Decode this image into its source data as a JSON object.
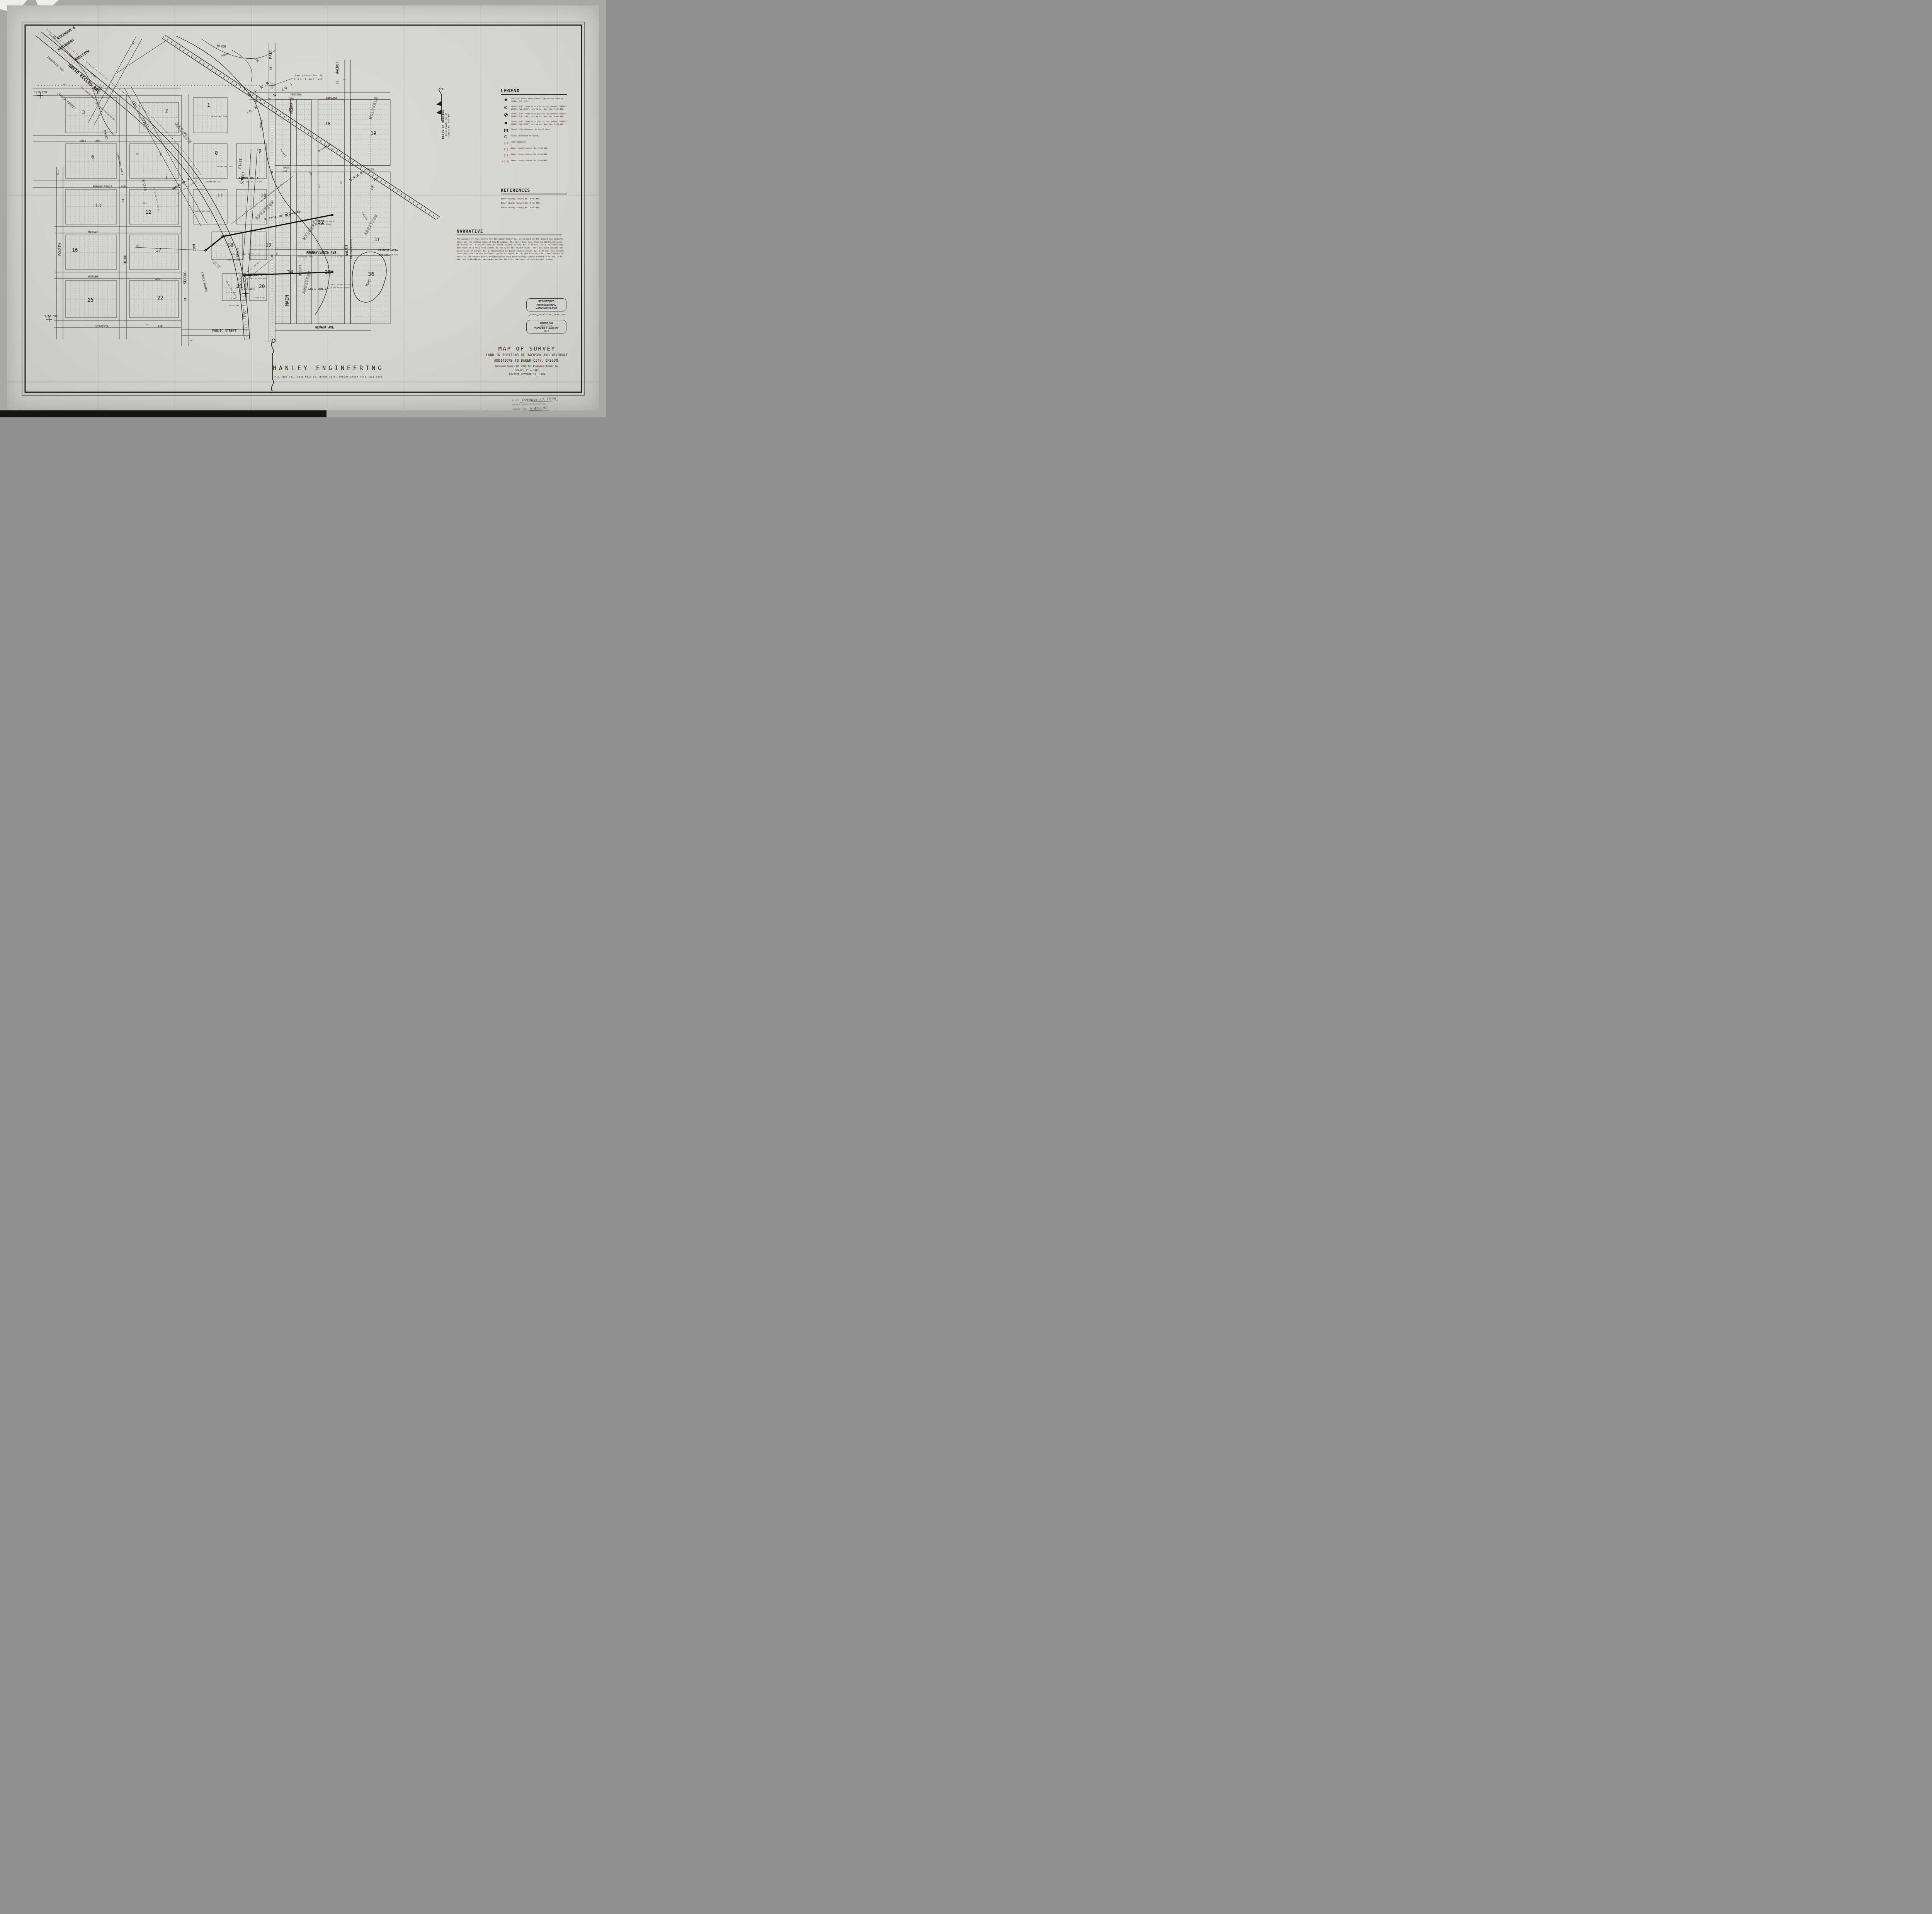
{
  "colors": {
    "paper": "#d8d6d1",
    "ink": "#1b1b1b",
    "stamp_ink": "#5e5e5e"
  },
  "legend": {
    "title": "LEGEND",
    "items": [
      {
        "sym": "dot",
        "sym_text": "",
        "text": "Set 5/8\" rebar with plastic cap marked \"HANLEY ENGRG. PLS 1817\"."
      },
      {
        "sym": "circledot",
        "sym_text": "",
        "text": "Found, 5/8\" rebar with plastic cap marked \"HANLEY ENGRG. PLS 1206\", set by Co. Sur. No. 9-40-466."
      },
      {
        "sym": "quarter",
        "sym_text": "",
        "text": "Found, 5/8\" rebar with plastic cap marked \"HANLEY ENGRG. PLS 1206\", set by Co. Sur. No. 9-40-486."
      },
      {
        "sym": "square",
        "sym_text": "",
        "text": "Found, 5/8\" rebar with plastic cap marked \"HANLEY ENGRG. PLS 1206\", set by Co. Sur. No. 9-40-490."
      },
      {
        "sym": "opensquare",
        "sym_text": "",
        "text": "Found, city monument in steel case."
      },
      {
        "sym": "opencircle",
        "sym_text": "",
        "text": "Found, monument as noted."
      },
      {
        "sym": "text",
        "sym_text": "(  )",
        "text": "Plat distance."
      },
      {
        "sym": "text",
        "sym_text": "{  }",
        "text": "Baker County Survey No. 9-40-466."
      },
      {
        "sym": "text",
        "sym_text": "[  ]",
        "text": "Baker County Survey No. 9-40-486."
      },
      {
        "sym": "text",
        "sym_text": "((  ))",
        "text": "Baker County Survey No. 9-40-490."
      }
    ]
  },
  "references": {
    "title": "REFERENCES",
    "items": [
      "Baker County Survey No. 9-40-466.",
      "Baker County Survey No. 9-40-486.",
      "Baker County Survey No. 9-40-490."
    ]
  },
  "narrative": {
    "title": "NARRATIVE",
    "text": "The purpose of this survey for Ellingson Timber Co. is to mark on the ground two property lines per the instructions of Rob Ellingson.  The first line runs from the Northeast corner of Parcel No. B established by Baker County Survey No. 9-40-486, in a Northeasterly direction to a 40.9 feet offset to the \u2104 of the Powder River.  This new line adjusts the South line of Parcel No. C established by Baker County Survey No. 9-40-490.  The second line runs from the the Southeast corner of Parcel No. B, due East to a 68.1 feet offset to the \u2104 of the Powder River.  Monumentation from Baker County Survey Numbers 9-40-466, 9-40-486, and 9-40-490 was recovered and was held for the basis of this subject survey."
  },
  "basis_of_bearing": {
    "title": "BASIS OF BEARING",
    "line1": "Baker County Map of",
    "line2": "Survey No. 9-40-490."
  },
  "title_block": {
    "title": "MAP OF SURVEY",
    "subtitle1": "LAND IN PORTIONS OF JACKSON AND WILOVALE",
    "subtitle2": "ADDITIONS TO BAKER CITY, OREGON.",
    "surveyed": "Surveyed August 19, 1999 for Ellingson Timber Co.",
    "scale": "Scale: 1\" = 100'",
    "revised": "REVISED OCTOBER 15, 1999"
  },
  "surveyor_stamp": {
    "line1": "REGISTERED",
    "line2": "PROFESSIONAL",
    "line3": "LAND SURVEYOR",
    "state": "OREGON",
    "date": "JULY, 13, 1979",
    "name": "THOMAS J. HANLEY",
    "number": "1817"
  },
  "filing_stamp": {
    "filed_label": "FILED",
    "filed_value": "October 13, 1999",
    "office": "BAKER COUNTY SURVEYOR",
    "survey_no_label": "SURVEY NO.",
    "survey_no_value": "9-40-502"
  },
  "firm_block": {
    "name": "HANLEY ENGINEERING",
    "address": "P.O. Box 701, 2043 Main St. BAKER CITY, OREGON 97814      (541) 523-3803"
  },
  "map_labels": [
    [
      "ATKINSON &",
      150,
      103,
      -34,
      9,
      "b"
    ],
    [
      "HENINGERS",
      152,
      132,
      -34,
      9,
      "b"
    ],
    [
      "ADDITION",
      196,
      158,
      -34,
      9,
      "b"
    ],
    [
      "INDUSTRIAL AVE.",
      121,
      148,
      42,
      6.5,
      "n"
    ],
    [
      "DAVID ECCLES RD.",
      176,
      170,
      42,
      11,
      "b"
    ],
    [
      "(TRUCK ROUTE)",
      147,
      242,
      42,
      8,
      "n"
    ],
    [
      "(OLD SUMPTER VALLEY R.R.)",
      208,
      225,
      42,
      4.5,
      "n"
    ],
    [
      "ORD. 2993, DEED 91-09-061",
      246,
      267,
      42,
      4.5,
      "n"
    ],
    [
      "OLD",
      137,
      96,
      42,
      5,
      "n"
    ],
    [
      "SETTLERS",
      176,
      142,
      42,
      5,
      "n"
    ],
    [
      "SLOUGH",
      234,
      190,
      42,
      5,
      "n"
    ],
    [
      "1/16 COR.",
      88,
      241,
      0,
      7,
      "n"
    ],
    [
      "AVE.",
      240,
      234,
      0,
      7,
      "n"
    ],
    [
      "60'",
      163,
      220,
      0,
      4.5,
      "n"
    ],
    [
      "ROSE",
      256,
      245,
      -70,
      9,
      "n"
    ],
    [
      "ST.",
      346,
      116,
      -70,
      7,
      "n"
    ],
    [
      "CARY",
      341,
      264,
      58,
      8,
      "n"
    ],
    [
      "STREET",
      366,
      308,
      58,
      8,
      "n"
    ],
    [
      "JACKSON",
      452,
      320,
      55,
      13,
      "o"
    ],
    [
      "ST.",
      152,
      452,
      -90,
      7,
      "n"
    ],
    [
      "FOURTH",
      158,
      662,
      -90,
      9,
      "n"
    ],
    [
      "ST.",
      321,
      523,
      -90,
      7,
      "n"
    ],
    [
      "THIRD",
      327,
      686,
      -90,
      9,
      "n"
    ],
    [
      "SECOND",
      482,
      735,
      -90,
      9,
      "n"
    ],
    [
      "ST.",
      482,
      779,
      -90,
      7,
      "n"
    ],
    [
      "OHIO",
      206,
      367,
      0,
      7,
      "n"
    ],
    [
      "AVE.",
      247,
      367,
      0,
      7,
      "n"
    ],
    [
      "PENNSYLVANIA",
      240,
      485,
      0,
      7,
      "n"
    ],
    [
      "AVE.",
      313,
      485,
      0,
      7,
      "n"
    ],
    [
      "NEVADA",
      228,
      602,
      0,
      7,
      "n"
    ],
    [
      "WABASH",
      228,
      718,
      0,
      7,
      "n"
    ],
    [
      "AVE.",
      402,
      724,
      0,
      7,
      "n"
    ],
    [
      "VIRGINIA",
      247,
      847,
      0,
      7,
      "n"
    ],
    [
      "AVE.",
      408,
      847,
      0,
      7,
      "n"
    ],
    [
      "1/16 COR.",
      115,
      821,
      0,
      7,
      "n"
    ],
    [
      "DAVID",
      268,
      338,
      76,
      8,
      "n"
    ],
    [
      "(INDUSTRIAL AVE.)",
      301,
      394,
      76,
      6,
      "n"
    ],
    [
      "ECCLES",
      368,
      466,
      78,
      8,
      "n"
    ],
    [
      "IN. 31\u00b0 43' 30\" W. 979.19']",
      397,
      486,
      78,
      4,
      "n"
    ],
    [
      "ROAD",
      498,
      632,
      80,
      8,
      "n"
    ],
    [
      "(TRUCK ROUTE)",
      520,
      704,
      77,
      7,
      "n"
    ],
    [
      "3",
      212,
      295,
      0,
      13,
      "n"
    ],
    [
      "6",
      236,
      410,
      0,
      13,
      "n"
    ],
    [
      "13",
      246,
      536,
      0,
      13,
      "n"
    ],
    [
      "16",
      186,
      651,
      0,
      13,
      "n"
    ],
    [
      "23",
      226,
      781,
      0,
      13,
      "n"
    ],
    [
      "2",
      427,
      291,
      0,
      13,
      "n"
    ],
    [
      "7",
      411,
      404,
      0,
      13,
      "n"
    ],
    [
      "12",
      376,
      553,
      0,
      13,
      "n"
    ],
    [
      "17",
      402,
      651,
      0,
      13,
      "n"
    ],
    [
      "22",
      407,
      775,
      0,
      13,
      "n"
    ],
    [
      "1",
      536,
      276,
      0,
      13,
      "n"
    ],
    [
      "8",
      556,
      400,
      0,
      13,
      "n"
    ],
    [
      "9",
      669,
      395,
      0,
      13,
      "n"
    ],
    [
      "11",
      562,
      510,
      0,
      13,
      "n"
    ],
    [
      "10",
      674,
      510,
      0,
      13,
      "n"
    ],
    [
      "18",
      588,
      638,
      0,
      13,
      "n"
    ],
    [
      "19",
      687,
      638,
      0,
      13,
      "n"
    ],
    [
      "21",
      613,
      745,
      0,
      13,
      "n"
    ],
    [
      "20",
      670,
      745,
      0,
      13,
      "n"
    ],
    [
      "PARCEL NO. A",
      448,
      492,
      -33,
      7,
      "b"
    ],
    [
      "BA. CO. SURV. NO. 9-40-466",
      460,
      502,
      -33,
      3.8,
      "n"
    ],
    [
      "PARCEL NO. C",
      618,
      464,
      0,
      7,
      "b"
    ],
    [
      "BA. CO. SURV. NO. 9-40-490",
      618,
      472,
      0,
      3.8,
      "n"
    ],
    [
      "PARCEL NO. B",
      628,
      714,
      0,
      7,
      "b"
    ],
    [
      "BA. CO. SURV. NO. 9-40-486",
      628,
      722,
      0,
      3.8,
      "n"
    ],
    [
      "VACATED ORD. 1728",
      546,
      303,
      0,
      4,
      "n"
    ],
    [
      "VACATED ORD. 1728",
      561,
      433,
      0,
      4,
      "n"
    ],
    [
      "VACATED ORD. 2054",
      532,
      472,
      0,
      4,
      "n"
    ],
    [
      "VACATED ORD. 2054",
      503,
      548,
      0,
      4,
      "n"
    ],
    [
      "VACATED ORD. 1638",
      592,
      792,
      0,
      4,
      "n"
    ],
    [
      "FIRST",
      623,
      437,
      -83,
      9,
      "n"
    ],
    [
      "STREET",
      629,
      477,
      -83,
      9,
      "n"
    ],
    [
      "FIRST",
      637,
      827,
      -90,
      9,
      "n"
    ],
    [
      "(FRONT)",
      617,
      670,
      -90,
      7,
      "n"
    ],
    [
      "MAIN",
      703,
      152,
      -90,
      9,
      "n"
    ],
    [
      "ST.",
      703,
      181,
      -90,
      7,
      "n"
    ],
    [
      "MAIN",
      747,
      792,
      -90,
      12,
      "n"
    ],
    [
      "PUBLIC STREET",
      549,
      859,
      0,
      8,
      "n"
    ],
    [
      "((S. 31\u00b0 43' 30\" E.,))",
      597,
      660,
      0,
      5.5,
      "n"
    ],
    [
      "((20.00'))",
      586,
      674,
      0,
      5.5,
      "n"
    ],
    [
      "N. 77\u00b019' 20\" E., 460.80'",
      685,
      570,
      -12,
      6.5,
      "b"
    ],
    [
      "(N. 58\u00b0 16' 32\" E., 412.00'))",
      676,
      523,
      -40,
      4.5,
      "n"
    ],
    [
      "[S. 58\u00b0 16' 52\" W., 250.00']",
      616,
      726,
      -40,
      4.5,
      "n"
    ],
    [
      "348.48' bet. mons.]",
      584,
      727,
      58,
      4.5,
      "n"
    ],
    [
      "EAST, 330.37'",
      798,
      750,
      0,
      7,
      "b"
    ],
    [
      "East \u00bc Corner Sec. 20,",
      764,
      197,
      0,
      5.5,
      "n"
    ],
    [
      "T. 9 S., R. 40 E., W.M.",
      760,
      207,
      0,
      5.5,
      "n"
    ],
    [
      "40.9' Offset to the \u2104",
      808,
      574,
      0,
      4.5,
      "n"
    ],
    [
      "of the Powder River.",
      806,
      582,
      0,
      4.5,
      "n"
    ],
    [
      "68.1' Offset to the \u2104",
      856,
      738,
      0,
      4.5,
      "n"
    ],
    [
      "of the Powder River.",
      854,
      746,
      0,
      4.5,
      "n"
    ],
    [
      "1/16 COR.",
      622,
      750,
      0,
      7,
      "n"
    ],
    [
      "U.P.R.R.",
      646,
      250,
      -33,
      10,
      "sp"
    ],
    [
      "(O.W.R. & N. CO.)",
      640,
      296,
      -33,
      9,
      "sp"
    ],
    [
      "U.P.R.R.",
      907,
      470,
      -33,
      9,
      "n"
    ],
    [
      "OCCIDENTAL",
      825,
      394,
      -33,
      6,
      "n"
    ],
    [
      "PACIFIC",
      725,
      388,
      58,
      6,
      "n"
    ],
    [
      "AVE.",
      799,
      445,
      58,
      6,
      "n"
    ],
    [
      "PACIFIC",
      936,
      551,
      58,
      5.5,
      "n"
    ],
    [
      "RIVER",
      561,
      121,
      6,
      8,
      "n"
    ],
    [
      "POWDER",
      573,
      147,
      -18,
      6,
      "n"
    ],
    [
      "DR.",
      660,
      153,
      55,
      8,
      "n"
    ],
    [
      "RIVER",
      664,
      265,
      -80,
      6,
      "n"
    ],
    [
      "POWDER",
      676,
      332,
      -80,
      6,
      "n"
    ],
    [
      "INDIANA",
      751,
      247,
      0,
      7,
      "n"
    ],
    [
      "AVE.",
      749,
      258,
      0,
      7,
      "n"
    ],
    [
      "INDIANA",
      843,
      256,
      0,
      7,
      "n"
    ],
    [
      "RESORT ST.",
      757,
      294,
      -90,
      8,
      "n"
    ],
    [
      "RESORT",
      780,
      714,
      -90,
      8,
      "n"
    ],
    [
      "WALNUT",
      876,
      192,
      -90,
      9,
      "n"
    ],
    [
      "ST.",
      876,
      218,
      -90,
      7,
      "n"
    ],
    [
      "70'",
      886,
      208,
      0,
      4.5,
      "n"
    ],
    [
      "WALNUT",
      900,
      662,
      -90,
      8,
      "n"
    ],
    [
      "(NON-CONSTRUCTED)",
      911,
      674,
      -90,
      5.5,
      "n"
    ],
    [
      "OHIO",
      950,
      441,
      0,
      7,
      "n"
    ],
    [
      "AVE.",
      966,
      492,
      -90,
      7,
      "n"
    ],
    [
      "OHIO",
      733,
      436,
      0,
      6,
      "n"
    ],
    [
      "AVE.",
      733,
      445,
      0,
      6,
      "n"
    ],
    [
      "PENNSYLVANIA",
      979,
      650,
      0,
      7,
      "n"
    ],
    [
      "(NON-CONSTRUCTED)",
      979,
      661,
      0,
      5,
      "n"
    ],
    [
      "PENNSYLVANIA AVE.",
      793,
      657,
      0,
      8,
      "b"
    ],
    [
      "VACATED ORD. 2054",
      770,
      666,
      0,
      3.8,
      "n"
    ],
    [
      "V. 117 P. 168",
      856,
      666,
      0,
      3.8,
      "n"
    ],
    [
      "NEVADA AVE.",
      816,
      850,
      0,
      8,
      "b"
    ],
    [
      "V.132 P.349",
      584,
      759,
      0,
      4,
      "n"
    ],
    [
      "V.115 P.599",
      584,
      774,
      0,
      4,
      "n"
    ],
    [
      "V.132 P.349",
      658,
      772,
      0,
      4,
      "n"
    ],
    [
      "POND",
      951,
      742,
      -65,
      8,
      "n"
    ],
    [
      "17",
      745,
      288,
      0,
      12,
      "n"
    ],
    [
      "18",
      841,
      324,
      0,
      12,
      "n"
    ],
    [
      "19",
      959,
      349,
      0,
      12,
      "n"
    ],
    [
      "31",
      964,
      469,
      0,
      12,
      "n"
    ],
    [
      "33",
      737,
      560,
      0,
      14,
      "n"
    ],
    [
      "32",
      822,
      579,
      0,
      14,
      "n"
    ],
    [
      "31",
      968,
      624,
      0,
      12,
      "n"
    ],
    [
      "34",
      742,
      709,
      0,
      14,
      "n"
    ],
    [
      "35",
      840,
      709,
      0,
      14,
      "n"
    ],
    [
      "36",
      952,
      714,
      0,
      14,
      "n"
    ],
    [
      "WILOVALE",
      962,
      309,
      -75,
      10,
      "o"
    ],
    [
      "ADDITION",
      948,
      609,
      -60,
      10,
      "o"
    ],
    [
      "WILOVALE",
      789,
      622,
      -55,
      11,
      "o"
    ],
    [
      "ADDITION",
      665,
      569,
      -45,
      11,
      "o"
    ],
    [
      "ADDITION",
      789,
      760,
      -75,
      10,
      "o"
    ],
    [
      "Fnd. 5/8\" rebar,",
      546,
      670,
      42,
      3.8,
      "n"
    ],
    [
      "badly bent",
      550,
      680,
      42,
      3.8,
      "n"
    ],
    [
      "60'",
      352,
      400,
      0,
      4.5,
      "n"
    ],
    [
      "60'",
      352,
      638,
      0,
      4.5,
      "n"
    ],
    [
      "60'",
      477,
      347,
      0,
      4.5,
      "n"
    ],
    [
      "50'",
      491,
      883,
      0,
      4.5,
      "n"
    ],
    [
      "33'",
      378,
      842,
      0,
      4.5,
      "n"
    ],
    [
      "(100')",
      432,
      466,
      -90,
      4,
      "n"
    ],
    [
      "(50')",
      368,
      527,
      0,
      4,
      "n"
    ],
    [
      "(100')",
      884,
      480,
      -90,
      4,
      "n"
    ],
    [
      "(25')",
      828,
      488,
      -90,
      4,
      "n"
    ],
    [
      "60'",
      718,
      659,
      -90,
      4.5,
      "n"
    ]
  ]
}
